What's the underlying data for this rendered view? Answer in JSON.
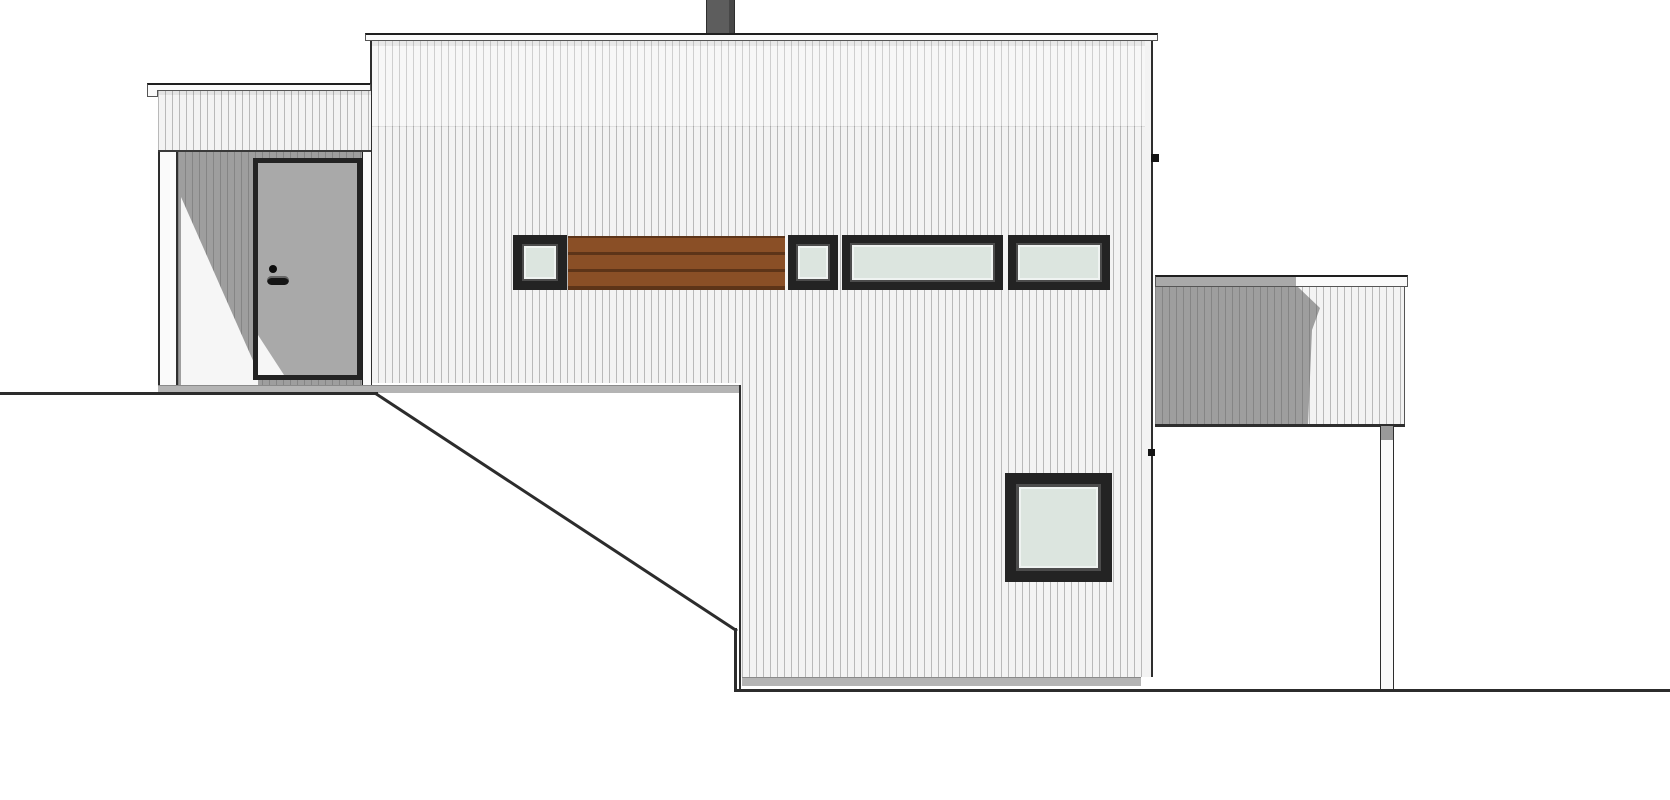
{
  "document": {
    "title": "House side elevation drawing",
    "type": "architectural-elevation",
    "text_content": "none (drawing contains no text)"
  },
  "palette": {
    "paper": "#ffffff",
    "ink": "#1f1f1f",
    "mid": "#555555",
    "edge": "#2e2e2e",
    "siding": "#f3f3f3",
    "siding_line": "#b9b9b9",
    "shade": "#9e9e9e",
    "shade_line": "#858585",
    "door": "#a9a9a9",
    "wedge": "#f6f6f6",
    "glass": "#dce5df",
    "frame": "#232323",
    "frame_inner": "#4c4c4c",
    "wood": "#8a4f26",
    "wood_dark": "#5d3418",
    "plinth": "#b4b4b4",
    "plinth_dark": "#8a8a8a",
    "chimney": "#5d5d5d",
    "chimney_dark": "#474747",
    "ground": "#2c2c2c",
    "rail": "#fafafa",
    "rail_shadow": "#a9a9a9",
    "post_top": "#9a9a9a"
  },
  "elements": [
    {
      "name": "chimney",
      "bbox": [
        706,
        0,
        29,
        35
      ]
    },
    {
      "name": "upper-volume",
      "bbox": [
        371,
        33,
        781,
        350
      ],
      "cladding": "vertical-siding"
    },
    {
      "name": "entry-volume",
      "bbox": [
        147,
        83,
        224,
        310
      ],
      "features": [
        "fascia",
        "porch-post",
        "entry-door",
        "cast-shadow"
      ]
    },
    {
      "name": "entry-door",
      "bbox": [
        253,
        158,
        109,
        222
      ],
      "hardware": [
        "peephole",
        "lever-handle"
      ]
    },
    {
      "name": "window-band",
      "bbox": [
        513,
        235,
        597,
        55
      ],
      "parts": [
        "small-window",
        "wood-slat-panel",
        "small-window",
        "long-window",
        "long-window"
      ]
    },
    {
      "name": "lower-volume",
      "bbox": [
        740,
        383,
        412,
        303
      ],
      "cladding": "vertical-siding"
    },
    {
      "name": "square-window",
      "bbox": [
        1005,
        473,
        107,
        109
      ]
    },
    {
      "name": "deck-volume",
      "bbox": [
        1155,
        275,
        253,
        150
      ],
      "features": [
        "top-rail",
        "shadowed-siding",
        "support-post"
      ]
    },
    {
      "name": "terrain-left",
      "line": [
        [
          0,
          393
        ],
        [
          377,
          393
        ]
      ]
    },
    {
      "name": "terrain-slope",
      "line": [
        [
          377,
          393
        ],
        [
          735,
          629
        ]
      ]
    },
    {
      "name": "terrain-right",
      "line": [
        [
          735,
          691
        ],
        [
          1670,
          691
        ]
      ]
    }
  ]
}
